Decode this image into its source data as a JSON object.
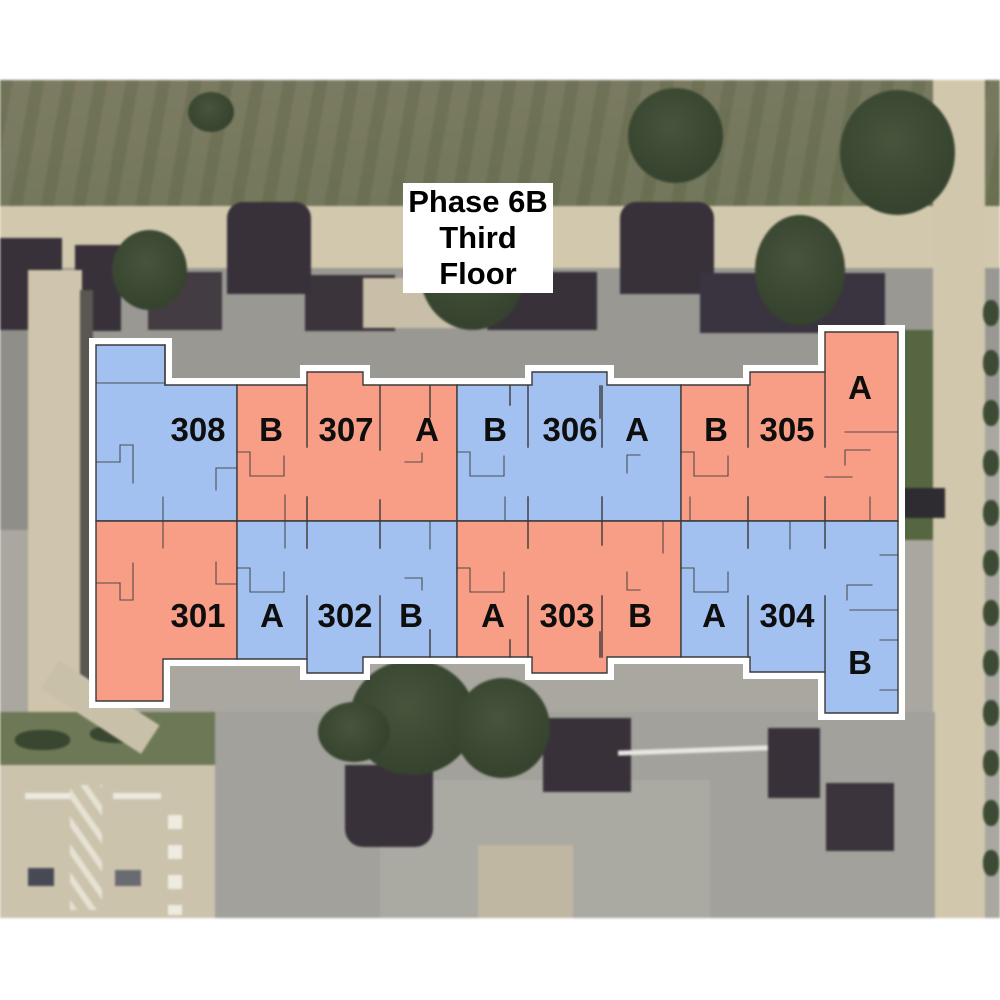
{
  "title": {
    "lines": [
      "Phase 6B",
      "Third",
      "Floor"
    ]
  },
  "floorplan": {
    "colors": {
      "blue": "#a3c1f0",
      "salmon": "#f89e87",
      "outline_white": "#ffffff",
      "wall_line": "#3a3a3a",
      "label_text": "#0e0e0e"
    },
    "top_row": [
      {
        "unit": "308",
        "text": "308",
        "color": "blue"
      },
      {
        "unit": "307",
        "text": "B",
        "color": "salmon"
      },
      {
        "unit": "307",
        "text": "307",
        "color": "salmon"
      },
      {
        "unit": "307",
        "text": "A",
        "color": "salmon"
      },
      {
        "unit": "306",
        "text": "B",
        "color": "blue"
      },
      {
        "unit": "306",
        "text": "306",
        "color": "blue"
      },
      {
        "unit": "306",
        "text": "A",
        "color": "blue"
      },
      {
        "unit": "305",
        "text": "B",
        "color": "salmon"
      },
      {
        "unit": "305",
        "text": "305",
        "color": "salmon"
      },
      {
        "unit": "305",
        "text": "A",
        "color": "salmon"
      }
    ],
    "bottom_row": [
      {
        "unit": "301",
        "text": "301",
        "color": "salmon"
      },
      {
        "unit": "302",
        "text": "A",
        "color": "blue"
      },
      {
        "unit": "302",
        "text": "302",
        "color": "blue"
      },
      {
        "unit": "302",
        "text": "B",
        "color": "blue"
      },
      {
        "unit": "303",
        "text": "A",
        "color": "salmon"
      },
      {
        "unit": "303",
        "text": "303",
        "color": "salmon"
      },
      {
        "unit": "303",
        "text": "B",
        "color": "salmon"
      },
      {
        "unit": "304",
        "text": "A",
        "color": "blue"
      },
      {
        "unit": "304",
        "text": "304",
        "color": "blue"
      },
      {
        "unit": "304",
        "text": "B",
        "color": "blue"
      }
    ]
  }
}
